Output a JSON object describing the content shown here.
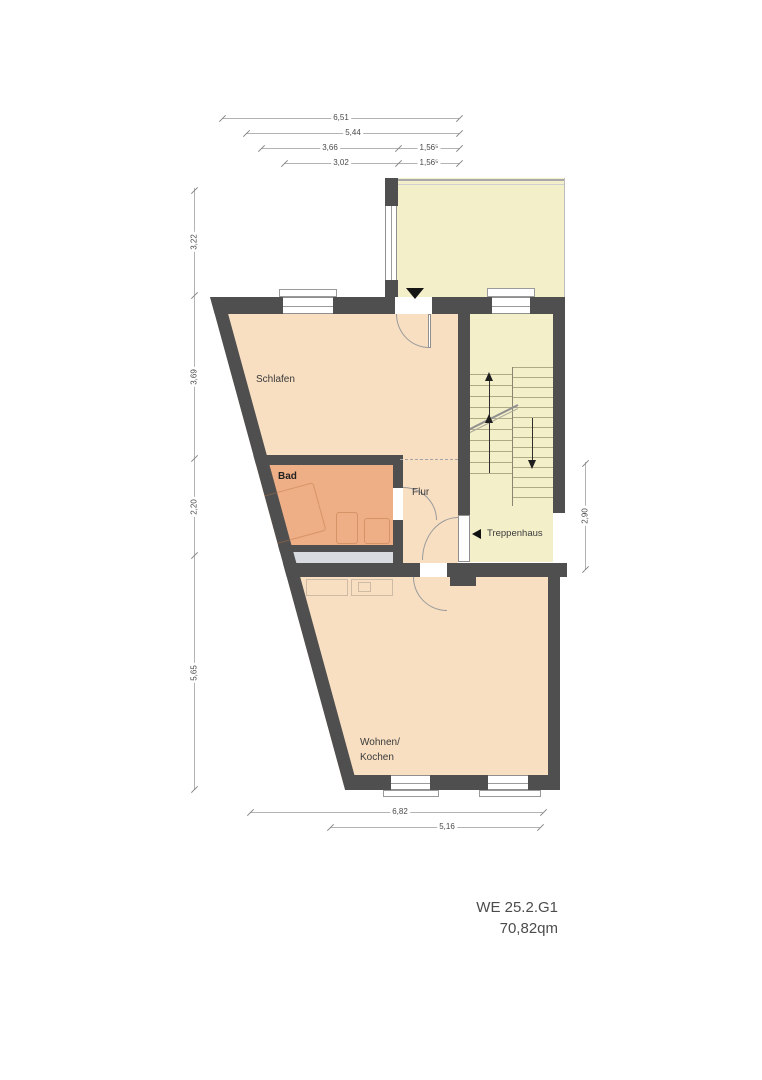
{
  "plan": {
    "title_line1": "WE 25.2.G1",
    "title_line2": "70,82qm"
  },
  "rooms": {
    "schlafen": "Schlafen",
    "bad": "Bad",
    "flur": "Flur",
    "treppenhaus": "Treppenhaus",
    "wohnen_line1": "Wohnen/",
    "wohnen_line2": "Kochen"
  },
  "dims": {
    "top_total": "6,51",
    "top_sub1": "5,44",
    "top_sub2a": "3,66",
    "top_sub2b": "1,56⁵",
    "top_sub3a": "3,02",
    "top_sub3b": "1,56⁵",
    "left_1": "3,22",
    "left_2": "3,69",
    "left_3": "2,20",
    "left_4": "5,65",
    "right_1": "2,90",
    "bottom_1": "6,82",
    "bottom_2": "5,16"
  },
  "colors": {
    "wall": "#4f4f4f",
    "room": "#f8dfc2",
    "bathroom": "#efaf86",
    "stairwell": "#f3efc9",
    "shaft": "#d8dbe0"
  }
}
